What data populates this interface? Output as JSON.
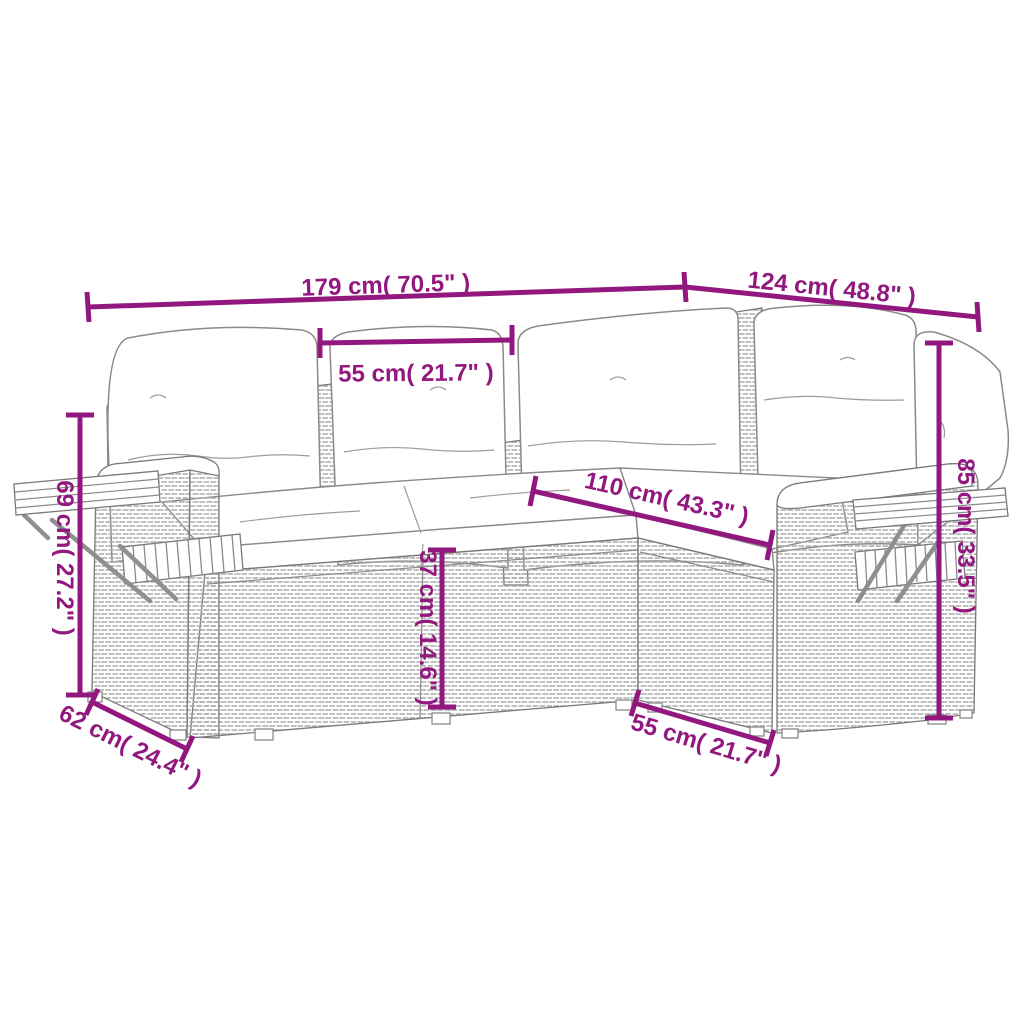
{
  "figure": {
    "title": "Corner sofa set dimension diagram",
    "subject": "L-shaped poly rattan garden sofa set with cushions and wooden shelf armrests",
    "accent_color": "#92187f",
    "line_color": "#7a7a7a",
    "background_color": "#ffffff"
  },
  "dimensions": {
    "overall_length": {
      "label": "179 cm( 70.5\" )"
    },
    "overall_width": {
      "label": "124 cm( 48.8\" )"
    },
    "back_cushion_width": {
      "label": "55 cm( 21.7\" )"
    },
    "inner_length": {
      "label": "110 cm( 43.3\" )"
    },
    "armrest_height": {
      "label": "69 cm( 27.2\" )"
    },
    "side_depth": {
      "label": "62 cm( 24.4\" )"
    },
    "seat_height": {
      "label": "37 cm( 14.6\" )"
    },
    "corner_seat_width": {
      "label": "55 cm( 21.7\" )"
    },
    "back_height": {
      "label": "85 cm( 33.5\" )"
    }
  }
}
